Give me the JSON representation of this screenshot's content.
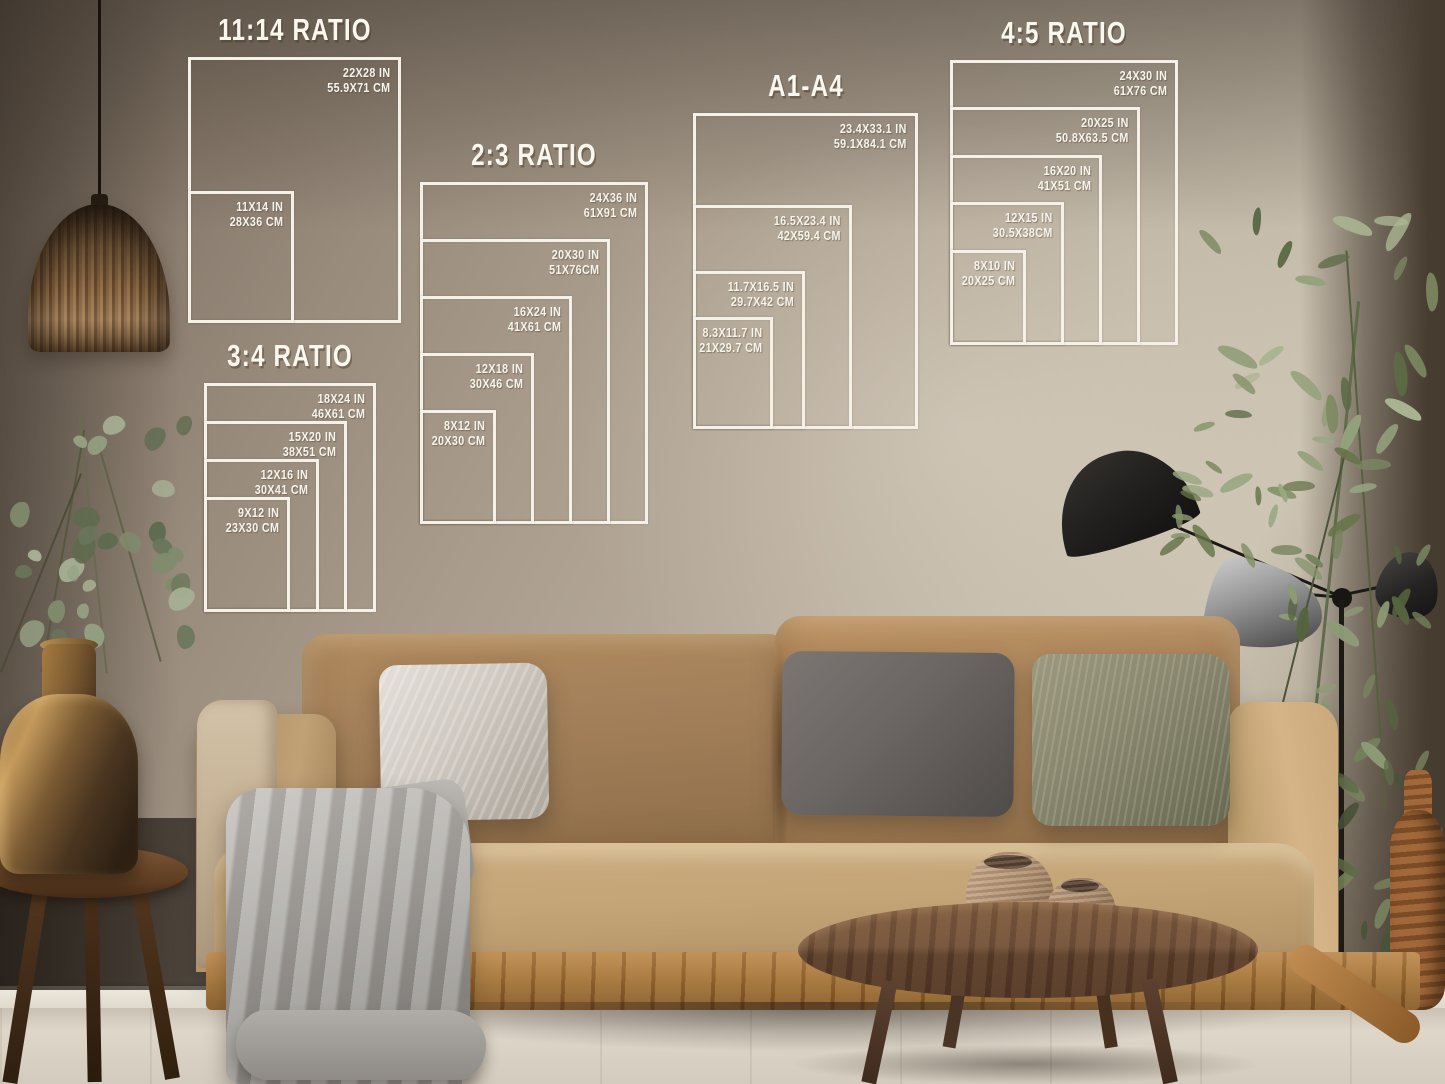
{
  "scene": {
    "setting": "living-room wall mockup showing poster print size guides",
    "objects": [
      "rattan pendant lamp",
      "eucalyptus stems in brass vase",
      "wooden stool",
      "camel velvet sofa",
      "silver pillow",
      "dark gray pillow",
      "olive pillow",
      "gray knit blanket",
      "beige arm throw",
      "round walnut coffee table",
      "two clay pots",
      "black sculptural floor lamp",
      "tall green plant",
      "woven rust vase"
    ]
  },
  "colors": {
    "chart_line": "#f5f1e8",
    "chart_text": "#f7f4ec",
    "wall_mid": "#a89b8b",
    "sofa_camel": "#c3a577",
    "sofa_back": "#a3805a",
    "pillow_silver": "#cfc9c1",
    "pillow_dark_gray": "#6b6663",
    "pillow_olive": "#8a8970",
    "blanket_gray": "#a9a6a1",
    "table_wood": "#6b4a33",
    "floor_wood": "#d6cfc2",
    "lamp_black": "#21201e",
    "brass": "#a77c44"
  },
  "charts": [
    {
      "id": "ratio-11-14",
      "title": "11:14 RATIO",
      "sizes": [
        {
          "in": "22X28 IN",
          "cm": "55.9X71 CM"
        },
        {
          "in": "11X14 IN",
          "cm": "28X36 CM"
        }
      ]
    },
    {
      "id": "ratio-2-3",
      "title": "2:3 RATIO",
      "sizes": [
        {
          "in": "24X36 IN",
          "cm": "61X91 CM"
        },
        {
          "in": "20X30 IN",
          "cm": "51X76CM"
        },
        {
          "in": "16X24 IN",
          "cm": "41X61 CM"
        },
        {
          "in": "12X18 IN",
          "cm": "30X46 CM"
        },
        {
          "in": "8X12 IN",
          "cm": "20X30 CM"
        }
      ]
    },
    {
      "id": "ratio-3-4",
      "title": "3:4 RATIO",
      "sizes": [
        {
          "in": "18X24 IN",
          "cm": "46X61 CM"
        },
        {
          "in": "15X20 IN",
          "cm": "38X51 CM"
        },
        {
          "in": "12X16 IN",
          "cm": "30X41 CM"
        },
        {
          "in": "9X12 IN",
          "cm": "23X30 CM"
        }
      ]
    },
    {
      "id": "a-series",
      "title": "A1-A4",
      "sizes": [
        {
          "in": "23.4X33.1 IN",
          "cm": "59.1X84.1 CM"
        },
        {
          "in": "16.5X23.4 IN",
          "cm": "42X59.4 CM"
        },
        {
          "in": "11.7X16.5 IN",
          "cm": "29.7X42 CM"
        },
        {
          "in": "8.3X11.7 IN",
          "cm": "21X29.7 CM"
        }
      ]
    },
    {
      "id": "ratio-4-5",
      "title": "4:5 RATIO",
      "sizes": [
        {
          "in": "24X30 IN",
          "cm": "61X76 CM"
        },
        {
          "in": "20X25 IN",
          "cm": "50.8X63.5 CM"
        },
        {
          "in": "16X20 IN",
          "cm": "41X51 CM"
        },
        {
          "in": "12X15 IN",
          "cm": "30.5X38CM"
        },
        {
          "in": "8X10 IN",
          "cm": "20X25 CM"
        }
      ]
    }
  ]
}
